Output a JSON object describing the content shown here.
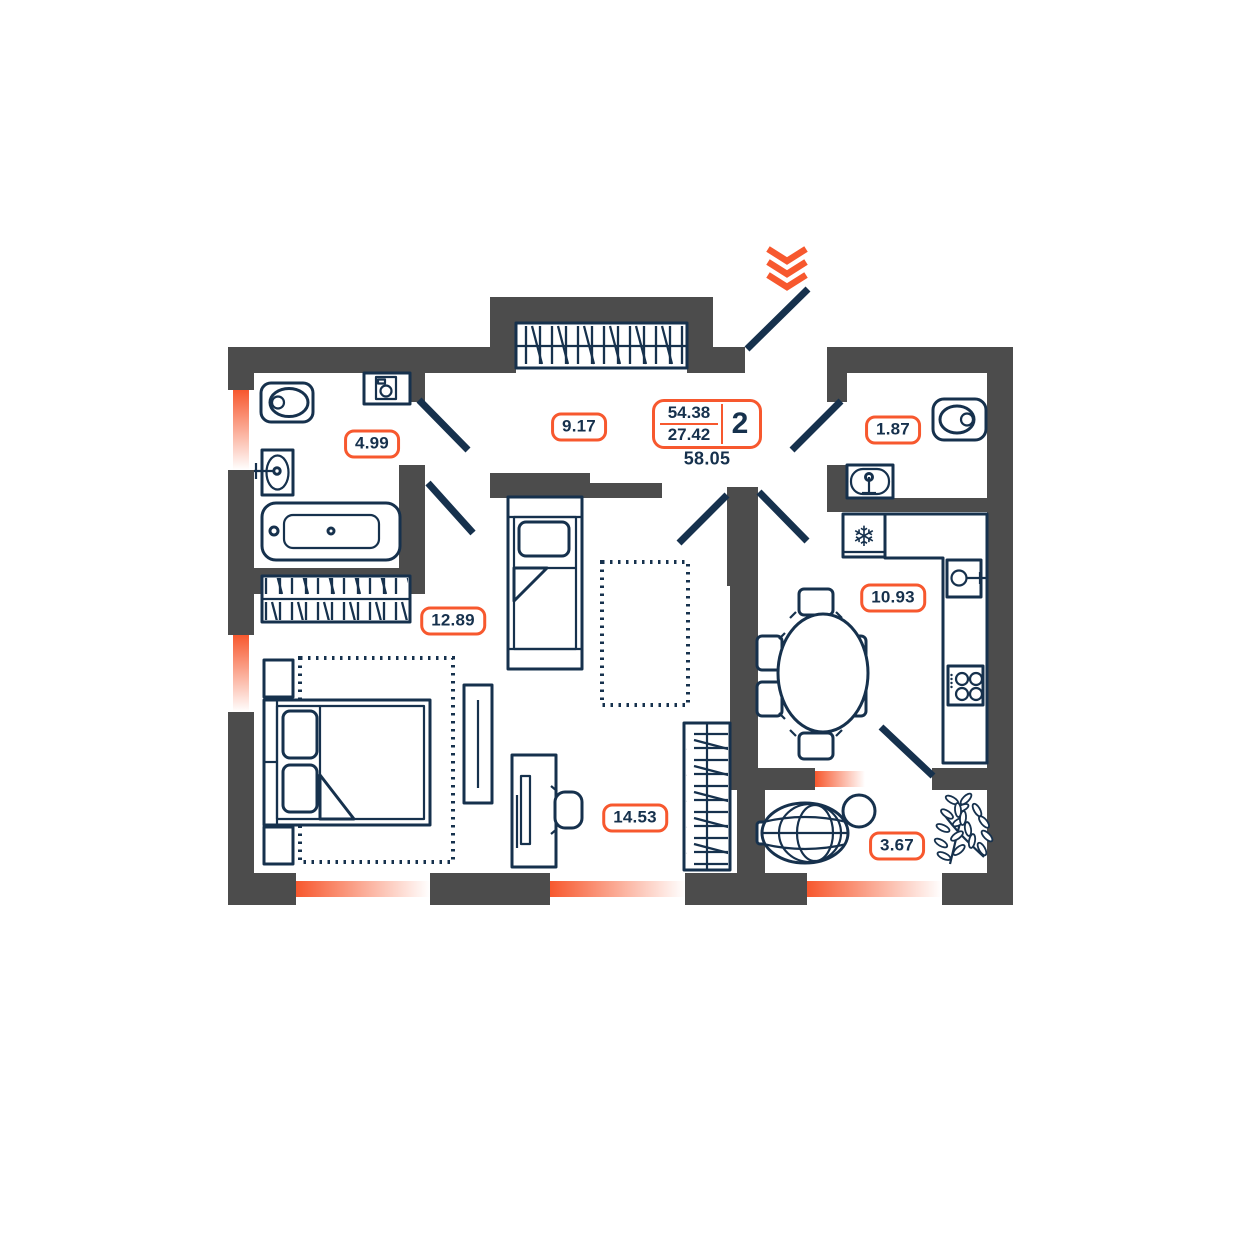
{
  "badge": {
    "total_area": "54.38",
    "living_area": "27.42",
    "rooms_count": "2",
    "full_area": "58.05"
  },
  "rooms": {
    "bathroom": {
      "area": "4.99"
    },
    "hallway": {
      "area": "9.17"
    },
    "wc": {
      "area": "1.87"
    },
    "kitchen": {
      "area": "10.93"
    },
    "bedroom": {
      "area": "12.89"
    },
    "living": {
      "area": "14.53"
    },
    "balcony": {
      "area": "3.67"
    }
  },
  "icons": {
    "snowflake": "❄",
    "entrance_chevron": "double-chevron-down"
  },
  "colors": {
    "accent_orange": "#F7582E",
    "outline_navy": "#16314D",
    "wall_gray": "#4C4C4C"
  }
}
